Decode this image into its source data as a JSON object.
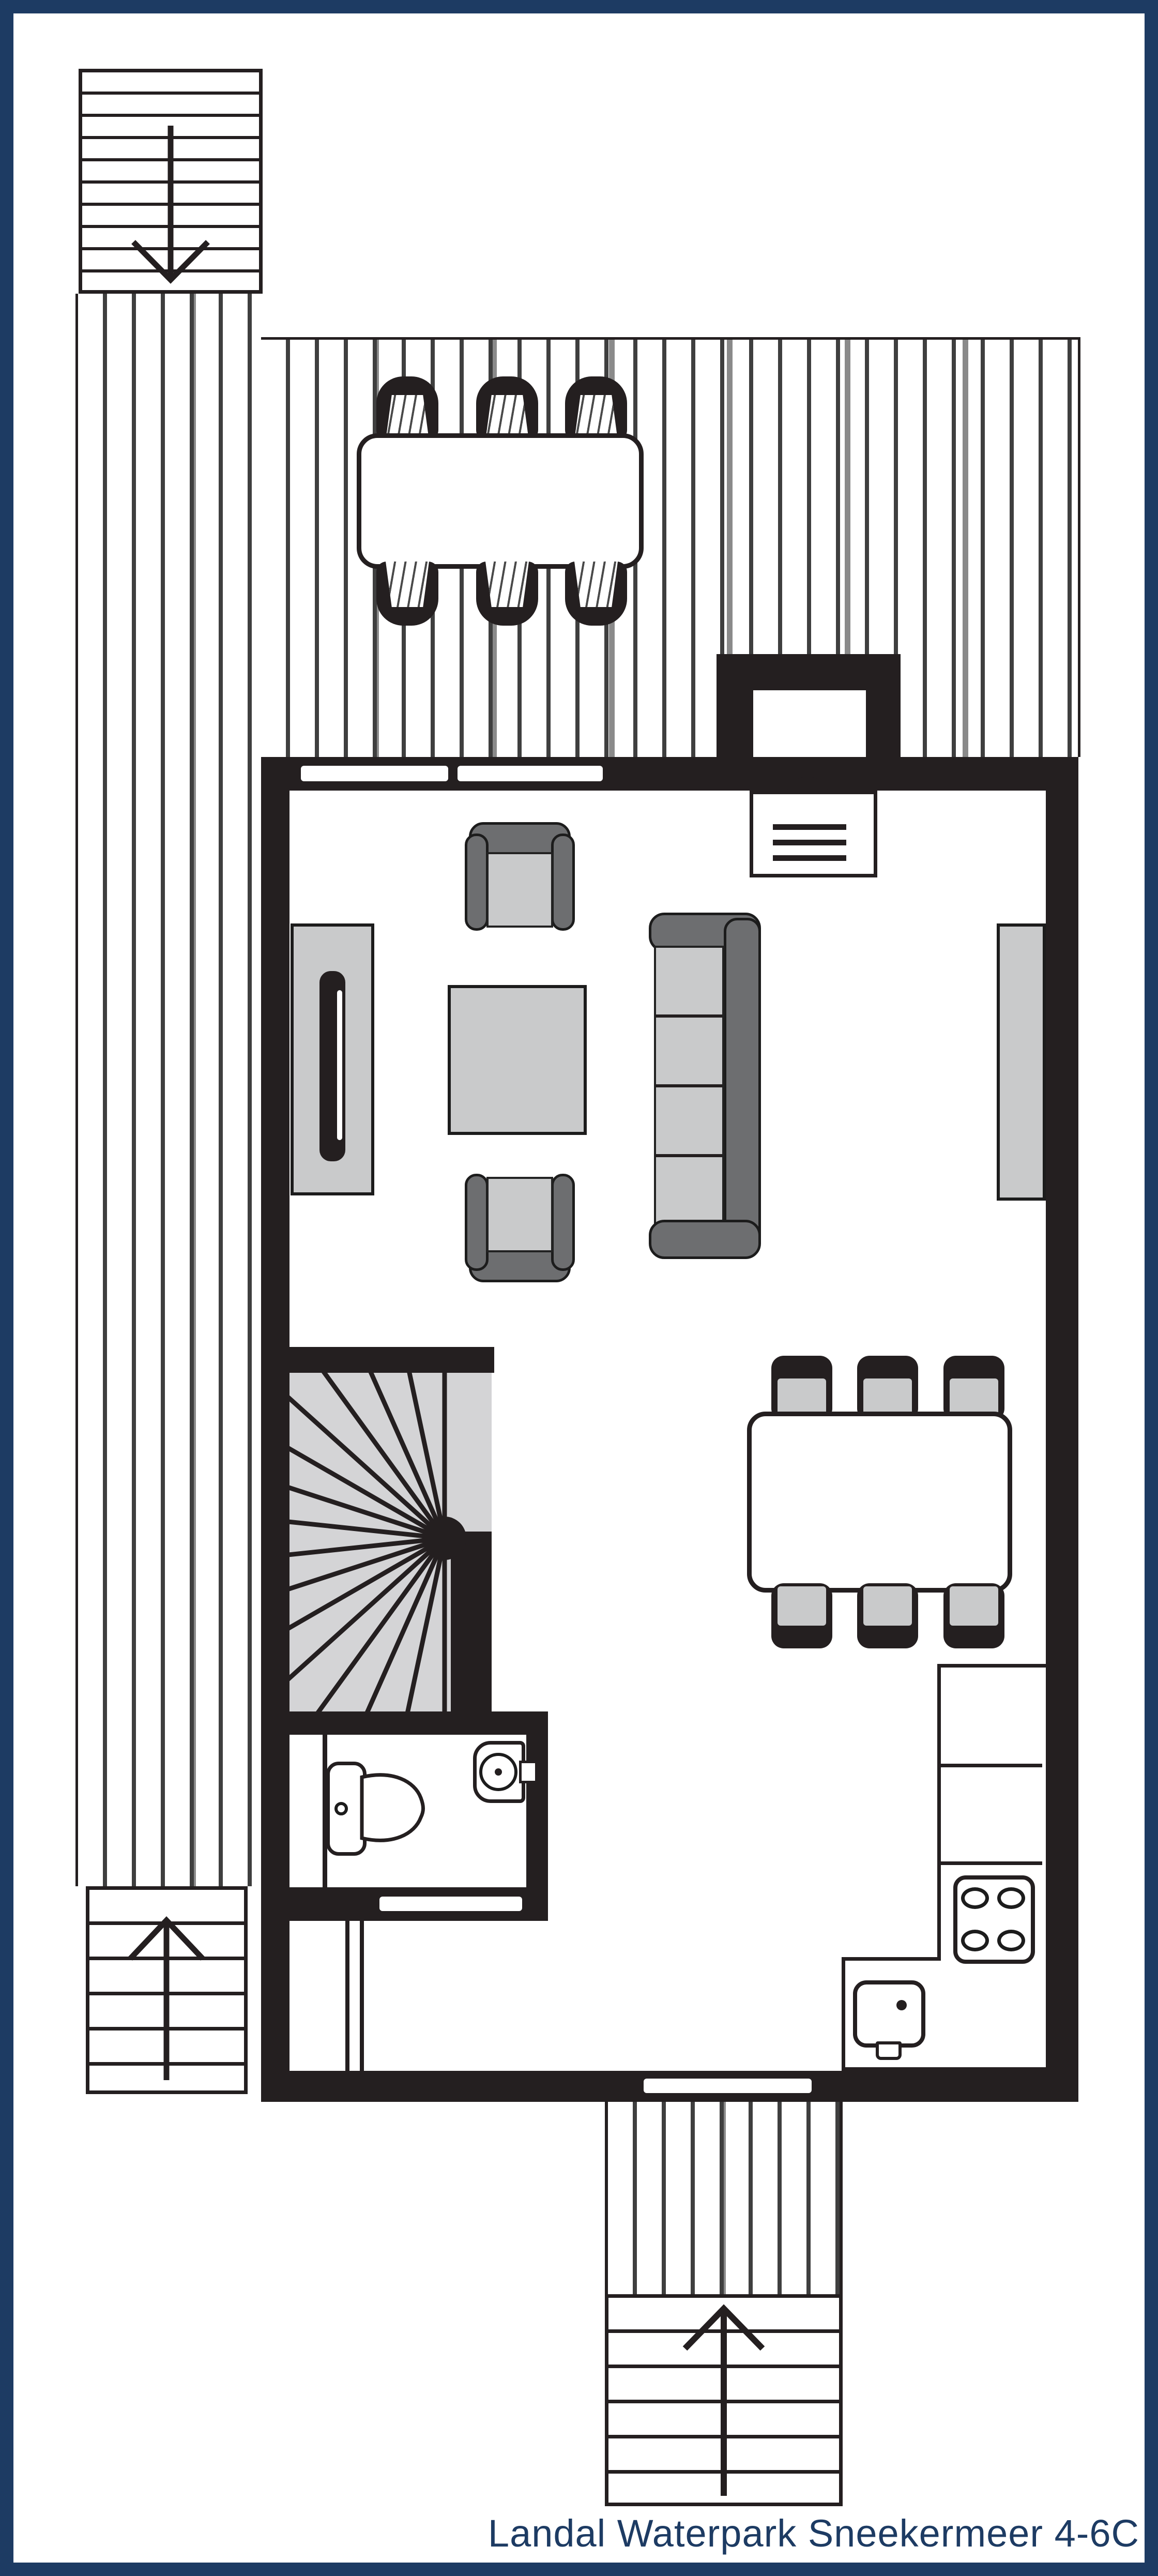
{
  "caption": {
    "text": "Landal Waterpark Sneekermeer 4-6C"
  },
  "colors": {
    "frame_navy": "#1d3b63",
    "caption_navy": "#1d3b63",
    "wall_black": "#241f20",
    "furniture_light": "#c9cacb",
    "furniture_dark": "#6d6e70",
    "stair_area_gray": "#d4d4d6",
    "plank_line": "#3f3f3f",
    "plank_line_gray": "#8a8a8a",
    "background": "#ffffff"
  }
}
